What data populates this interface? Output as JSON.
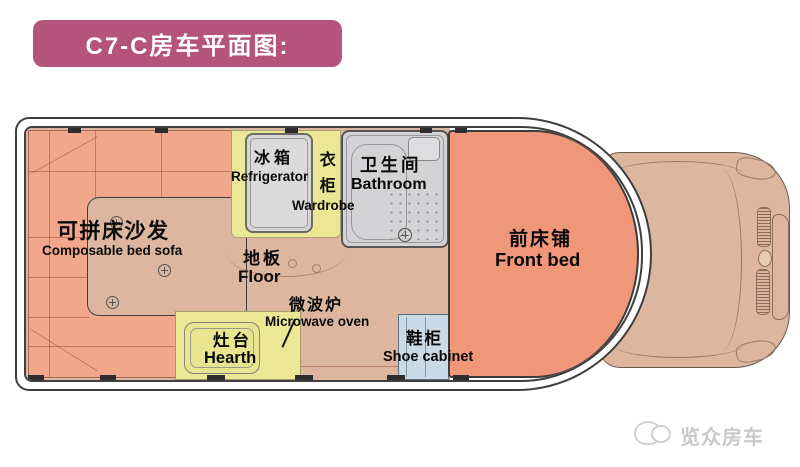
{
  "title_banner": {
    "text": "C7-C房车平面图:"
  },
  "plan": {
    "rooms": {
      "sofa": {
        "zh": "可拼床沙发",
        "en": "Composable bed sofa"
      },
      "refrigerator": {
        "zh": "冰箱",
        "en": "Refrigerator"
      },
      "wardrobe": {
        "zh": "衣柜",
        "en": "Wardrobe"
      },
      "bathroom": {
        "zh": "卫生间",
        "en": "Bathroom"
      },
      "floor": {
        "zh": "地板",
        "en": "Floor"
      },
      "microwave": {
        "zh": "微波炉",
        "en": "Microwave oven"
      },
      "hearth": {
        "zh": "灶台",
        "en": "Hearth"
      },
      "shoe_cabinet": {
        "zh": "鞋柜",
        "en": "Shoe cabinet"
      },
      "front_bed": {
        "zh": "前床铺",
        "en": "Front bed"
      }
    }
  },
  "watermark": {
    "brand": "览众房车"
  },
  "colors": {
    "banner_bg": "#b4547b",
    "banner_text": "#ffffff",
    "sofa": "#f2a78c",
    "front_bed": "#f0977a",
    "floor": "#dcb69e",
    "cabinet_yellow": "#ebe795",
    "bathroom_gray": "#d3d3d5",
    "refrigerator_gray": "#d6d6d6",
    "shoe_cabinet_blue": "#cadae6",
    "cab_body": "#dcb69e",
    "wall_line": "#3f3f3f",
    "label_text": "#000000",
    "watermark_gray": "#c9c9c9"
  }
}
